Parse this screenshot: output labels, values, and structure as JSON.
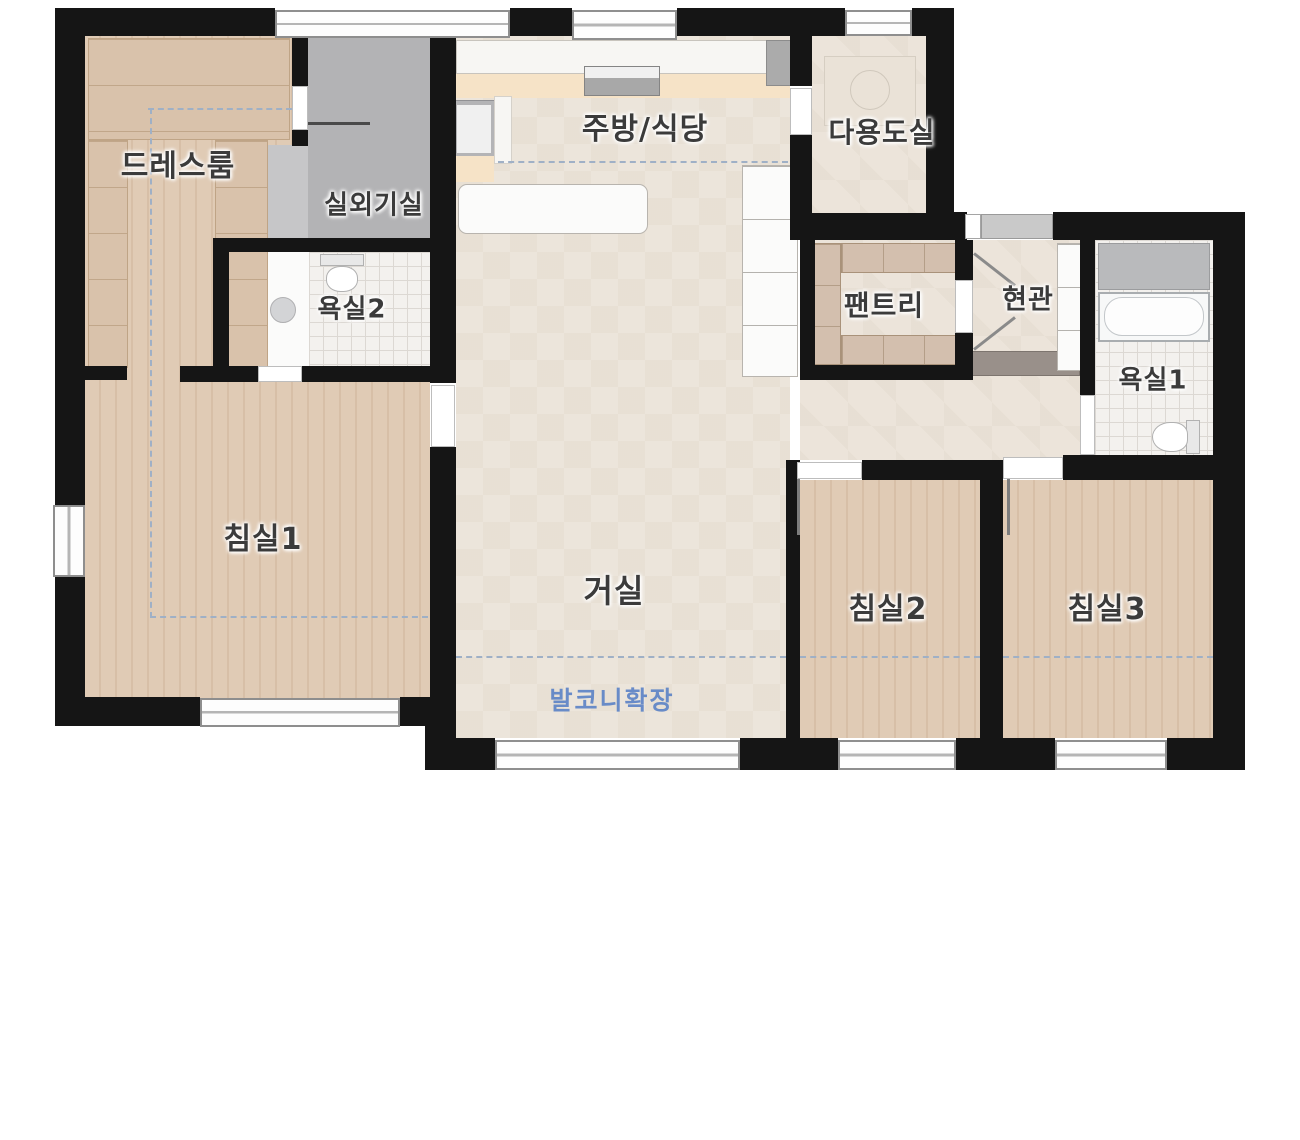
{
  "floorplan": {
    "title": "apartment-floor-plan",
    "rooms": [
      {
        "id": "dress-room",
        "label": "드레스룸"
      },
      {
        "id": "outdoor-unit-room",
        "label": "실외기실"
      },
      {
        "id": "kitchen-dining",
        "label": "주방/식당"
      },
      {
        "id": "utility-room",
        "label": "다용도실"
      },
      {
        "id": "bathroom-2",
        "label": "욕실2"
      },
      {
        "id": "pantry",
        "label": "팬트리"
      },
      {
        "id": "entrance",
        "label": "현관"
      },
      {
        "id": "bathroom-1",
        "label": "욕실1"
      },
      {
        "id": "bedroom-1",
        "label": "침실1"
      },
      {
        "id": "living-room",
        "label": "거실"
      },
      {
        "id": "bedroom-2",
        "label": "침실2"
      },
      {
        "id": "bedroom-3",
        "label": "침실3"
      }
    ],
    "balcony": {
      "label": "발코니확장",
      "color": "#5b82c6"
    },
    "colors": {
      "wall": "#151515",
      "wood_floor": "#e0cbb5",
      "light_floor": "#ece5db",
      "gray_room": "#b3b3b5",
      "tile": "#f3f1ee",
      "annotation_blue": "#5b82c6",
      "label_text": "#3b3b3b"
    }
  }
}
